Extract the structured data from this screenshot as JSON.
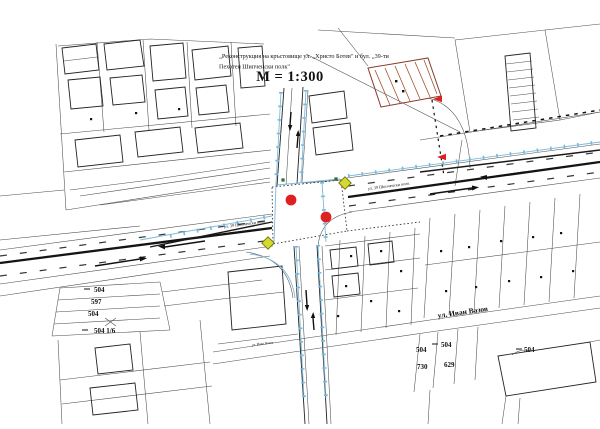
{
  "colors": {
    "red_marker": "#e02020",
    "yellow_marker_fill": "#d3da2b",
    "yellow_marker_stroke": "#6f6f18",
    "utility_line": "#7cb9da",
    "hatch": "#a0522d",
    "hatch_outline": "#8b3a2a",
    "tree": "#2e6b2e",
    "ink": "#141414"
  },
  "title_block": {
    "line1": "„Реконструкция на кръстовище ул. „Христо Ботев\" и бул. „39-ти",
    "line2": "Пехотен Шипченски полк\"",
    "scale": "М = 1:300"
  },
  "street_labels": [
    {
      "text": "ул. 39 Шипченски полк",
      "x": 224,
      "y": 228,
      "rotate": -7.5,
      "size": 4.2,
      "bold": false
    },
    {
      "text": "ул. 39 Шипченски полк",
      "x": 368,
      "y": 190,
      "rotate": -7.5,
      "size": 4.2,
      "bold": false
    },
    {
      "text": "ул. Иван Вазов",
      "x": 438,
      "y": 318,
      "rotate": -8,
      "size": 7.5,
      "bold": true
    },
    {
      "text": "ул. Иван Вазов",
      "x": 252,
      "y": 346,
      "rotate": -7,
      "size": 3.4,
      "bold": false
    }
  ],
  "parcel_numbers": [
    {
      "text": "504",
      "x": 94,
      "y": 292
    },
    {
      "text": "597",
      "x": 91,
      "y": 304
    },
    {
      "text": "504",
      "x": 88,
      "y": 316
    },
    {
      "text": "504 1/6",
      "x": 94,
      "y": 333
    },
    {
      "text": "504",
      "x": 416,
      "y": 352
    },
    {
      "text": "504",
      "x": 441,
      "y": 347
    },
    {
      "text": "730",
      "x": 417,
      "y": 369
    },
    {
      "text": "629",
      "x": 444,
      "y": 367
    },
    {
      "text": "504",
      "x": 524,
      "y": 352
    }
  ],
  "markers": {
    "red_circles": [
      {
        "x": 291,
        "y": 200
      },
      {
        "x": 326,
        "y": 217
      }
    ],
    "yellow_diamonds": [
      {
        "x": 345,
        "y": 183
      },
      {
        "x": 268,
        "y": 243
      }
    ],
    "red_arrows": [
      {
        "x": 433,
        "y": 99
      },
      {
        "x": 437,
        "y": 157
      }
    ],
    "trees": [
      {
        "x": 283,
        "y": 180
      },
      {
        "x": 336,
        "y": 179
      }
    ]
  }
}
